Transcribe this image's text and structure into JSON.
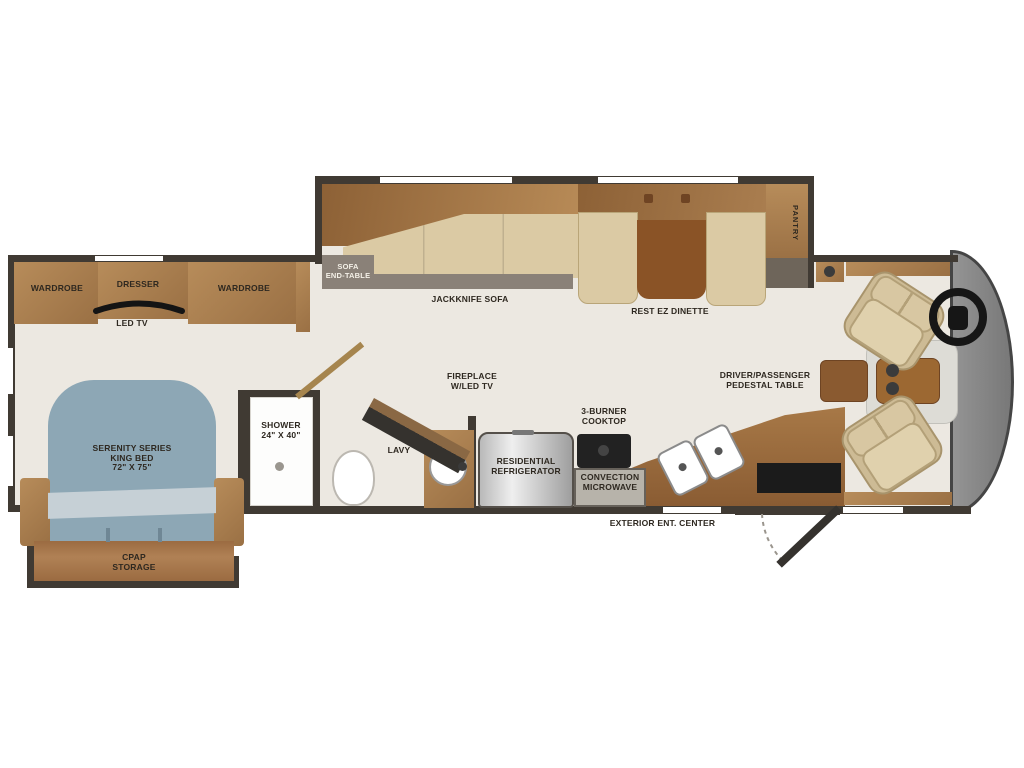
{
  "colors": {
    "wall": "#403a33",
    "floor": "#ece8e1",
    "cabinet": "#a97e50",
    "cabinet-dark": "#8a5c33",
    "cushion": "#dbcaa4",
    "bed": "#8da7b5",
    "bed-blanket": "#c6d0d6",
    "ledge": "#8a8178",
    "front-cap": "#868686",
    "seat": "#d2c09a",
    "steel-light": "#ededed",
    "steel-dark": "#9e9e9e"
  },
  "labels": {
    "wardrobe_left": "WARDROBE",
    "dresser": "DRESSER",
    "wardrobe_right": "WARDROBE",
    "led_tv": "LED TV",
    "bed": {
      "l1": "SERENITY SERIES",
      "l2": "KING BED",
      "l3": "72\" X 75\""
    },
    "cpap": {
      "l1": "CPAP",
      "l2": "STORAGE"
    },
    "shower": {
      "l1": "SHOWER",
      "l2": "24\" X 40\""
    },
    "lavy": "LAVY",
    "fireplace": {
      "l1": "FIREPLACE",
      "l2": "W/LED TV"
    },
    "sofa_end_table": {
      "l1": "SOFA",
      "l2": "END-TABLE"
    },
    "jackknife_sofa": "JACKKNIFE SOFA",
    "dinette": "REST EZ DINETTE",
    "pantry": "PANTRY",
    "fridge": {
      "l1": "RESIDENTIAL",
      "l2": "REFRIGERATOR"
    },
    "cooktop": {
      "l1": "3-BURNER",
      "l2": "COOKTOP"
    },
    "microwave": {
      "l1": "CONVECTION",
      "l2": "MICROWAVE"
    },
    "pedestal": {
      "l1": "DRIVER/PASSENGER",
      "l2": "PEDESTAL TABLE"
    },
    "exterior_ent": "EXTERIOR ENT. CENTER"
  }
}
